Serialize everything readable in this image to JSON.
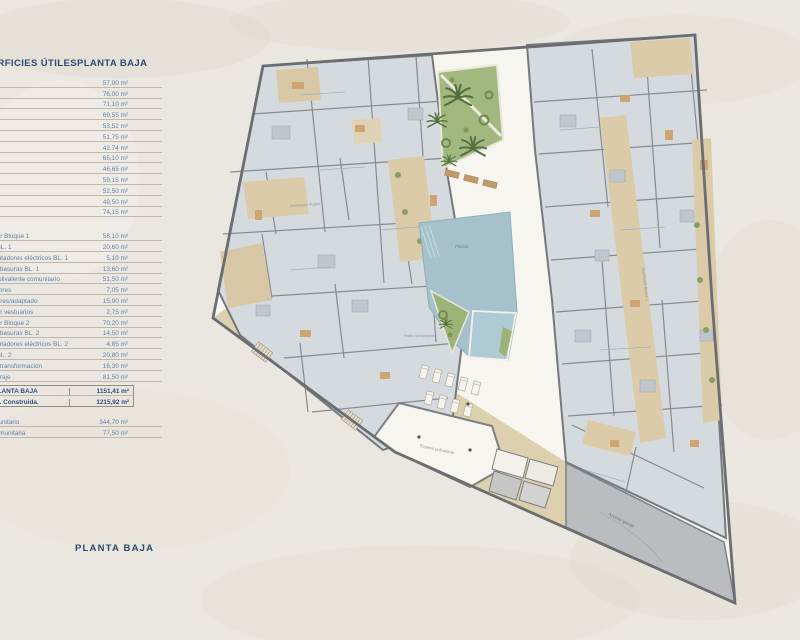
{
  "header": {
    "title_left": "SUPERFICIES ÚTILES",
    "title_right": "PLANTA BAJA"
  },
  "table": {
    "unit_rows": [
      {
        "label": "",
        "value": "57,00 m²"
      },
      {
        "label": "",
        "value": "76,00 m²"
      },
      {
        "label": "",
        "value": "71,10 m²"
      },
      {
        "label": "",
        "value": "69,55 m²"
      },
      {
        "label": "",
        "value": "53,52 m²"
      },
      {
        "label": "",
        "value": "51,75 m²"
      },
      {
        "label": "",
        "value": "42,74 m²"
      },
      {
        "label": "",
        "value": "65,10 m²"
      },
      {
        "label": "",
        "value": "46,65 m²"
      },
      {
        "label": "",
        "value": "59,15 m²"
      },
      {
        "label": "",
        "value": "52,50 m²"
      },
      {
        "label": "",
        "value": "49,50 m²"
      },
      {
        "label": "",
        "value": "74,15 m²"
      }
    ],
    "common_rows": [
      {
        "label": "Distribuidor Bloque 1",
        "value": "58,10 m²"
      },
      {
        "label": "Almacén BL. 1",
        "value": "20,60 m²"
      },
      {
        "label": "Cuarto contadores eléctricos BL. 1",
        "value": "5,10 m²"
      },
      {
        "label": "Cuarto de basuras BL. 1",
        "value": "13,60 m²"
      },
      {
        "label": "Espacio polivalente comunitario",
        "value": "51,50 m²"
      },
      {
        "label": "Aseo hombres",
        "value": "7,05 m²"
      },
      {
        "label": "Aseo mujeres/adaptado",
        "value": "15,90 m²"
      },
      {
        "label": "Distribuidor vestuarios",
        "value": "2,75 m²"
      },
      {
        "label": "Distribuidor Bloque 2",
        "value": "70,20 m²"
      },
      {
        "label": "Cuarto de basuras BL. 2",
        "value": "14,50 m²"
      },
      {
        "label": "Cuarto contadores eléctricos BL. 2",
        "value": "4,85 m²"
      },
      {
        "label": "Almacén BL. 2",
        "value": "20,80 m²"
      },
      {
        "label": "Centro de transformación",
        "value": "16,30 m²"
      },
      {
        "label": "Acceso garaje",
        "value": "81,50 m²"
      }
    ],
    "summary_rows": [
      {
        "label": "TOTAL PLANTA BAJA",
        "value": "1151,41 m²"
      },
      {
        "label": "Total Sup. Construida.",
        "value": "1215,92 m²"
      }
    ],
    "outdoor_rows": [
      {
        "label": "Patio comunitario",
        "value": "344,70 m²"
      },
      {
        "label": "Piscina comunitaria",
        "value": "77,50 m²"
      }
    ]
  },
  "plan": {
    "labels": {
      "pool": "Piscina",
      "patio": "Patio comunitario",
      "hall": "Espacio polivalente",
      "garage": "Acceso garaje",
      "corridor_b1": "Distribuidor Bloque 1",
      "corridor_b2": "Distribuidor Bloque 2"
    }
  },
  "footer": {
    "label": "PLANTA BAJA"
  }
}
